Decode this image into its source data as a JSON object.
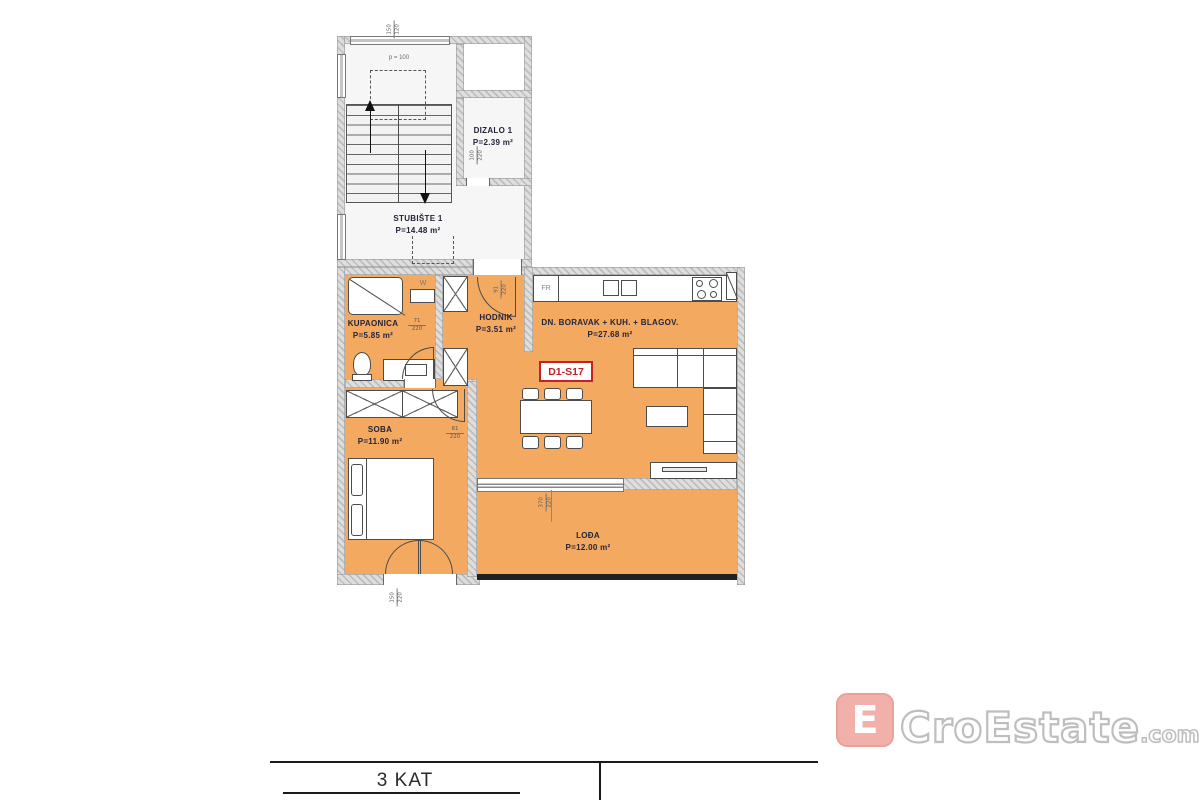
{
  "floor_title": "3 KAT",
  "unit_label": "D1-S17",
  "stairwell": {
    "name": "STUBIŠTE 1",
    "area": "P=14.48 m²",
    "parapet_note": "p = 100"
  },
  "elevator": {
    "name": "DIZALO 1",
    "area": "P=2.39 m²"
  },
  "rooms": {
    "kupaonica": {
      "name": "KUPAONICA",
      "area": "P=5.85 m²"
    },
    "hodnik": {
      "name": "HODNIK",
      "area": "P=3.51 m²"
    },
    "living": {
      "name": "DN. BORAVAK + KUH. + BLAGOV.",
      "area": "P=27.68 m²"
    },
    "soba": {
      "name": "SOBA",
      "area": "P=11.90 m²"
    },
    "lodja": {
      "name": "LOĐA",
      "area": "P=12.00 m²"
    }
  },
  "appliances": {
    "fridge": "FR",
    "washer": "W"
  },
  "dims": {
    "stair_window": {
      "w": "150",
      "h": "120"
    },
    "elevator_door": {
      "w": "100",
      "h": "220"
    },
    "entrance_door": {
      "w": "91",
      "h": "220"
    },
    "bathroom_door": {
      "w": "71",
      "h": "220"
    },
    "bedroom_door": {
      "w": "81",
      "h": "220"
    },
    "balcony_door": {
      "w": "150",
      "h": "220"
    },
    "loggia_door": {
      "w": "370",
      "h": "220"
    }
  },
  "watermark": {
    "brand": "CroEstate",
    "tld": ".com",
    "monogram": "E"
  },
  "colors": {
    "room_fill": "#F3AA60",
    "unit_red": "#C32027",
    "logo_pink": "#EE9D96",
    "wall_gray": "#CFCFCF"
  }
}
